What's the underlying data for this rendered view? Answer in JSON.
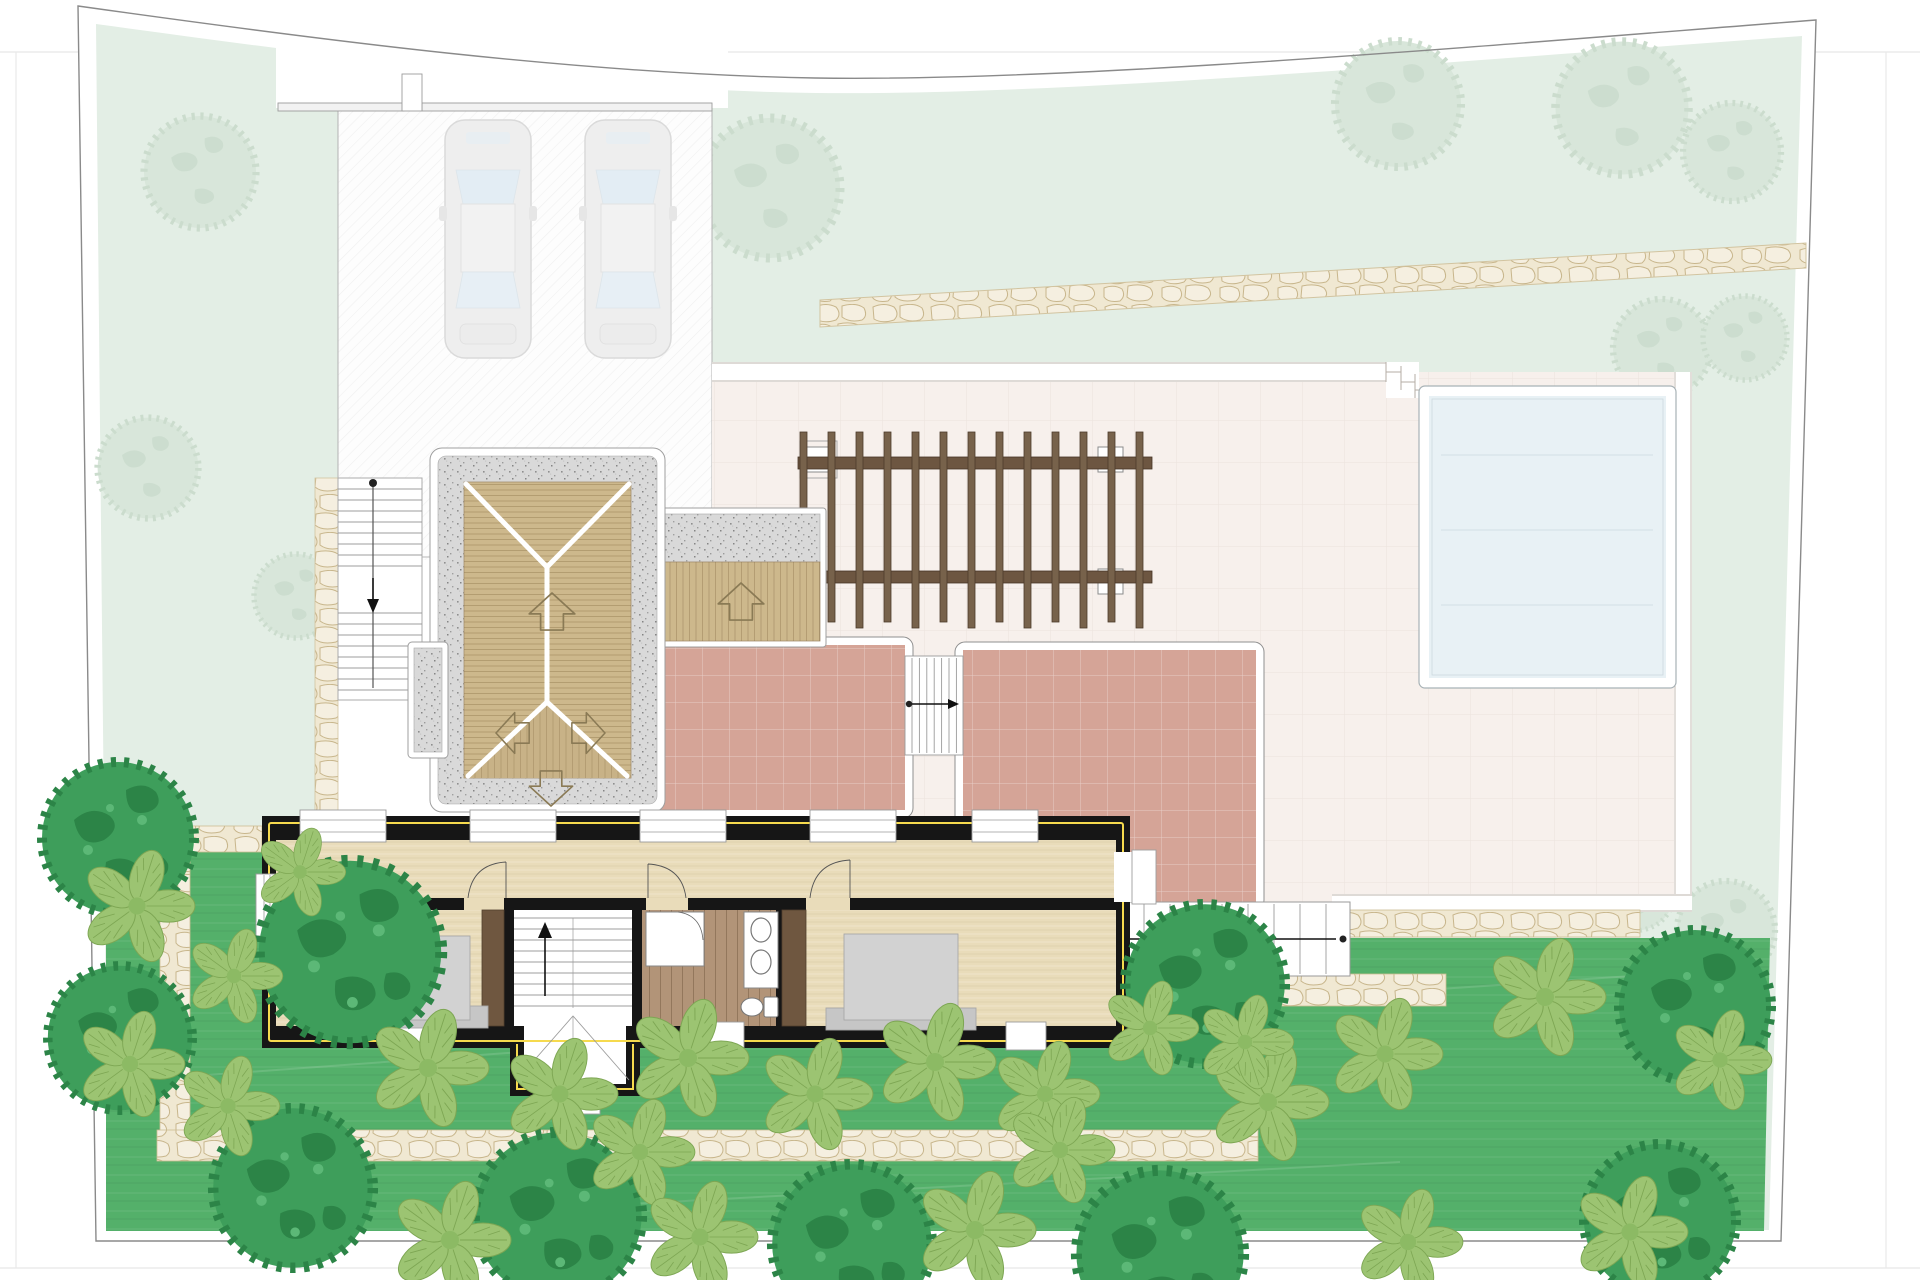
{
  "document": {
    "kind": "architectural-site-plan",
    "level_shown": "upper-floor-with-roofs-and-garden",
    "visible_text": []
  },
  "palette": {
    "page_bg": "#ffffff",
    "frame_line": "#e8e8e8",
    "boundary_line": "#8a8a8a",
    "pale_green": "#e3eee5",
    "pale_tree": "#d8e6da",
    "driveway": "#fdfdfd",
    "wall_line": "#9c9c9c",
    "car_body": "#eeeeee",
    "car_window": "#e3edf4",
    "stone_path": "#f0e8d2",
    "stone_line": "#c8b68c",
    "deck": "#f7f0ec",
    "deck_band_line": "#beb6ae",
    "terrace_tile": "#d5a497",
    "pool_water": "#e8f1f5",
    "pool_rim_line": "#a8b2b6",
    "pergola_wood": "#77624b",
    "gravel": "#d9d9d9",
    "roof_wood": "#cdb88c",
    "ridge_white": "#ffffff",
    "lawn_green": "#54b06a",
    "shrub_green": "#9cc472",
    "tree_green": "#3e9e5b",
    "house_wall": "#161616",
    "insulation_yellow": "#f6da4e",
    "floor_tan": "#e9dcba",
    "bath_wood": "#b29478",
    "wardrobe_brown": "#6f5740",
    "bed_gray": "#d2d2d2",
    "fixture_line": "#777777",
    "arrow_black": "#111111"
  },
  "site": {
    "boundary": "irregular plot, sagging top edge",
    "outer_garden": {
      "type": "pale lawn",
      "faint_trees": 12
    },
    "carport": {
      "cars": 2,
      "pillar": 1,
      "surface": "hatched concrete"
    },
    "entry_stairs": {
      "flights": 2,
      "direction_arrow": "down",
      "handrail_dot": true
    },
    "upper_stone_path": 1,
    "deck": {
      "type": "paved terrace platform",
      "edge_bands": "white with steps near pool"
    },
    "pool": {
      "shape": "rectangle",
      "rim": "white"
    },
    "tiled_terraces": 2,
    "terrace_stairs": {
      "direction_arrow": "right"
    },
    "garden_stairs": {
      "direction_arrow": "left",
      "treads": 11
    },
    "pergola": {
      "slats": 13,
      "beams": 2,
      "posts": 3
    },
    "lawn_garden": {
      "stone_paths": 4,
      "dark_trees": 10,
      "leafy_shrubs": 24
    }
  },
  "roofs": {
    "main_roof": {
      "border": "gravel",
      "deck_arrows": [
        "up",
        "left",
        "right",
        "down"
      ]
    },
    "entrance_canopy": {
      "border": "gravel",
      "deck_arrows": [
        "up"
      ]
    },
    "chimney_block": 1
  },
  "house_upper_floor": {
    "rooms": [
      "bedroom-1",
      "stairwell",
      "bathroom",
      "bedroom-2",
      "corridor"
    ],
    "windows_top_wall": 5,
    "stairwell": {
      "direction_arrow": "up"
    },
    "fixtures": {
      "beds": 2,
      "wardrobes": 2,
      "sinks": 2,
      "toilet": 1,
      "shower": 1
    },
    "wall_style": "black with yellow insulation line"
  }
}
